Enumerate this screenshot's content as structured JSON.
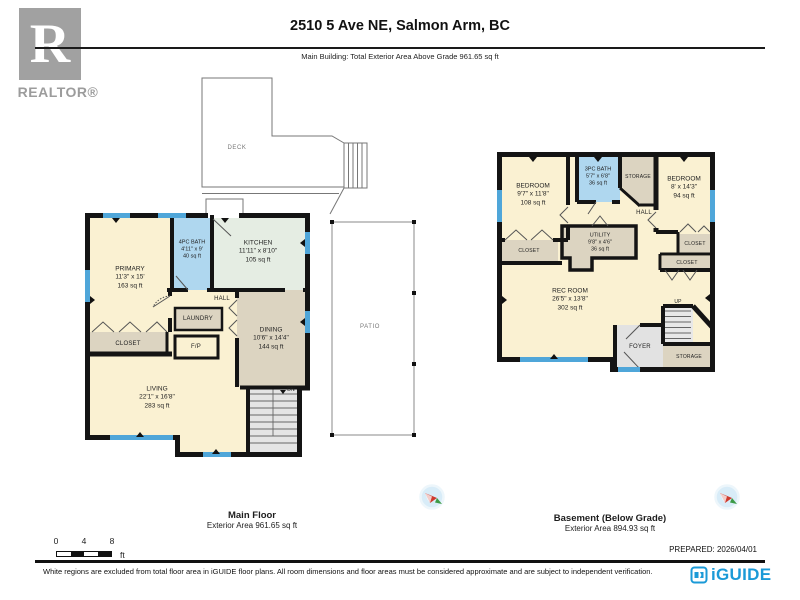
{
  "header": {
    "address": "2510 5 Ave NE, Salmon Arm, BC",
    "subtitle": "Main Building: Total Exterior Area Above Grade 961.65 sq ft"
  },
  "branding": {
    "realtor_letter": "R",
    "realtor_wordmark": "REALTOR®",
    "iguide_wordmark": "iGUIDE"
  },
  "main_floor": {
    "title": "Main Floor",
    "area_label": "Exterior Area 961.65 sq ft",
    "rooms": {
      "primary": {
        "name": "PRIMARY",
        "dims": "11'3\" x 15'",
        "area": "163 sq ft"
      },
      "bath": {
        "name": "4PC BATH",
        "dims": "4'11\" x 9'",
        "area": "40 sq ft"
      },
      "kitchen": {
        "name": "KITCHEN",
        "dims": "11'11\" x 8'10\"",
        "area": "105 sq ft"
      },
      "dining": {
        "name": "DINING",
        "dims": "10'6\" x 14'4\"",
        "area": "144 sq ft"
      },
      "living": {
        "name": "LIVING",
        "dims": "22'1\" x 16'8\"",
        "area": "283 sq ft"
      }
    },
    "labels": {
      "hall": "HALL",
      "laundry": "LAUNDRY",
      "fireplace": "F/P",
      "closet": "CLOSET",
      "stairs_down": "DN",
      "deck": "DECK",
      "patio": "PATIO"
    }
  },
  "basement": {
    "title": "Basement (Below Grade)",
    "area_label": "Exterior Area 894.93 sq ft",
    "rooms": {
      "bedroom_left": {
        "name": "BEDROOM",
        "dims": "9'7\" x 11'8\"",
        "area": "108 sq ft"
      },
      "bath": {
        "name": "3PC BATH",
        "dims": "5'7\" x 6'8\"",
        "area": "36 sq ft"
      },
      "bedroom_right": {
        "name": "BEDROOM",
        "dims": "8' x 14'3\"",
        "area": "94 sq ft"
      },
      "utility": {
        "name": "UTILITY",
        "dims": "9'8\" x 4'6\"",
        "area": "36 sq ft"
      },
      "rec_room": {
        "name": "REC ROOM",
        "dims": "26'5\" x 13'8\"",
        "area": "302 sq ft"
      }
    },
    "labels": {
      "hall": "HALL",
      "storage_top": "STORAGE",
      "storage_bottom": "STORAGE",
      "closet_left": "CLOSET",
      "closet_right": "CLOSET",
      "closet_right_lower": "CLOSET",
      "foyer": "FOYER",
      "stairs_up": "UP"
    }
  },
  "scale_bar": {
    "ticks": [
      "0",
      "4",
      "8"
    ],
    "unit": "ft"
  },
  "footer": {
    "prepared": "PREPARED: 2026/04/01",
    "disclaimer": "White regions are excluded from total floor area in iGUIDE floor plans. All room dimensions and floor areas must be considered approximate and are subject to independent verification."
  },
  "colors": {
    "wall": "#141414",
    "window_blue": "#4FA6D9",
    "room_cream": "#FAF1D2",
    "room_tan": "#DCD4C1",
    "room_blue": "#AFD7EF",
    "room_green": "#E5EDE3",
    "stairs_gray": "#E4E4E4",
    "iguide_blue": "#1B9AD7",
    "realtor_gray": "#9C9C9C"
  }
}
